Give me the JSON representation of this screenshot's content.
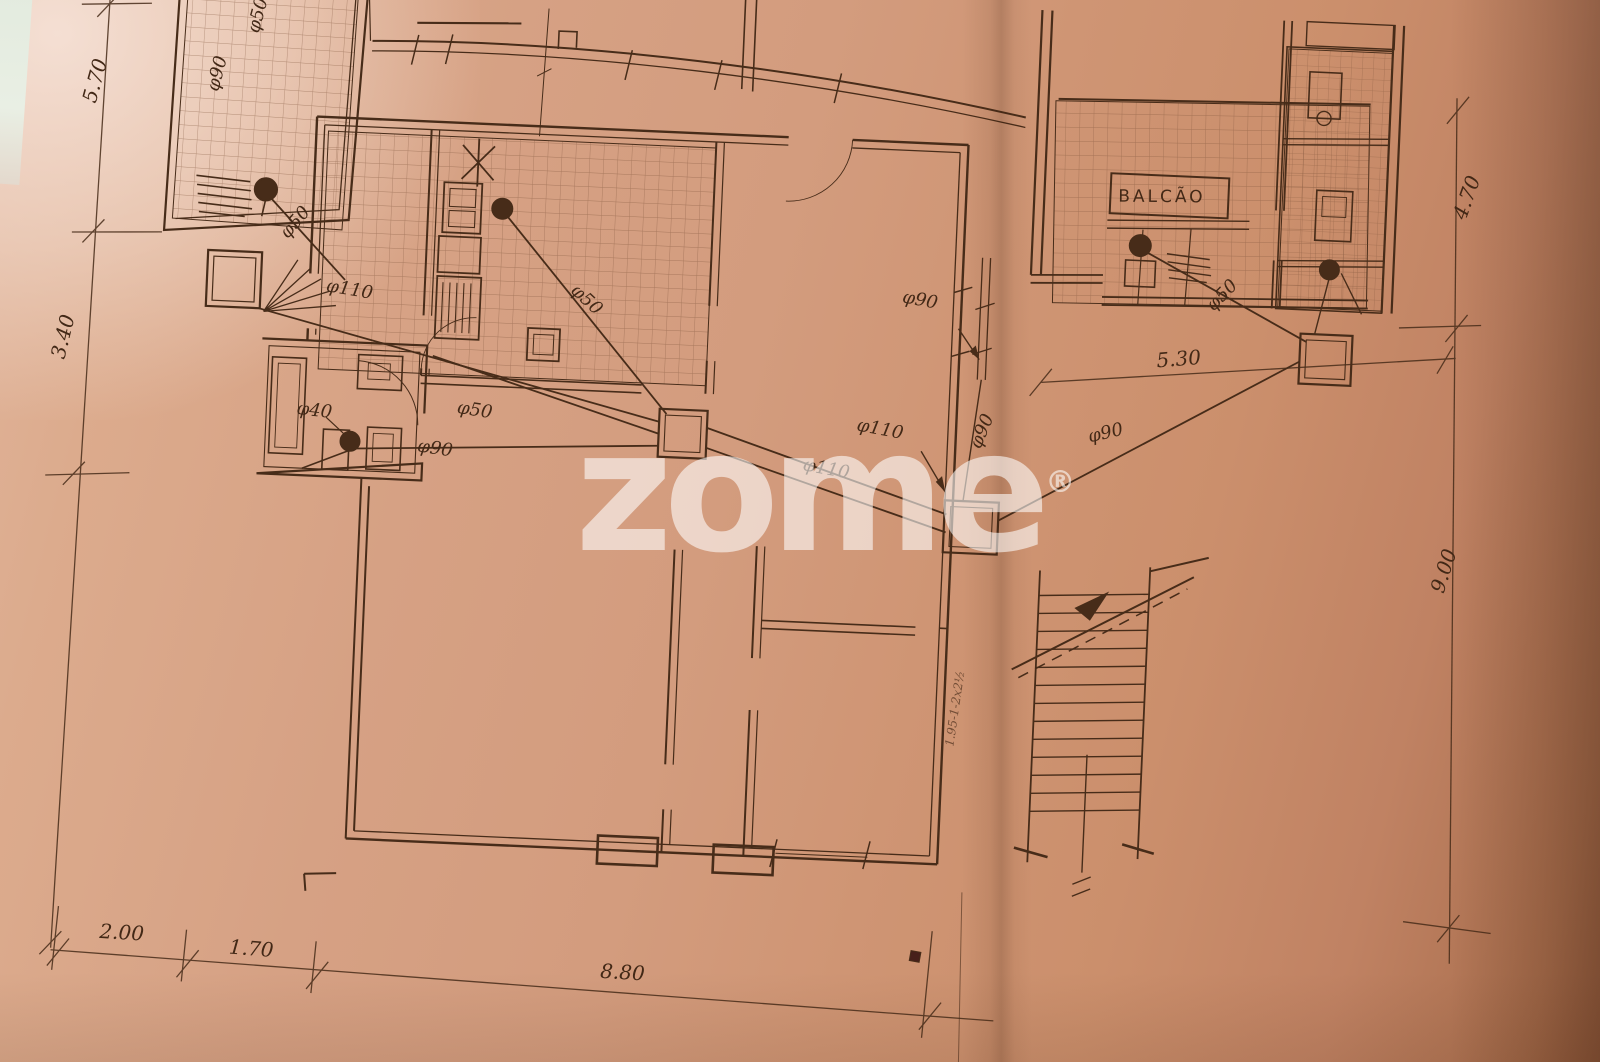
{
  "photo": {
    "watermark_text": "zome",
    "watermark_reg": "®",
    "paper_color": "#d6a184",
    "ink_color": "#472c19"
  },
  "plan": {
    "room_labels": {
      "balcao": "BALCÃO"
    },
    "dimensions": {
      "left_top": "5.70",
      "left_mid": "3.40",
      "bottom_1": "2.00",
      "bottom_2": "1.70",
      "bottom_3": "8.80",
      "right_top": "4.70",
      "right_side": "9.00",
      "upper_right": "5.30"
    },
    "pipe_labels": {
      "terrace_upper": "φ50",
      "terrace_lower": "φ90",
      "terrace_drain": "φ50",
      "main_left": "φ110",
      "kitchen_diag": "φ50",
      "hall_mid": "φ50",
      "bath_small": "φ40",
      "bath_main": "φ90",
      "center_a": "φ110",
      "center_b": "φ110",
      "wall_leader": "φ90",
      "wall_vertical": "φ90",
      "yard_cross": "φ90",
      "balcao_drain": "φ50"
    },
    "handwritten_note": "1.95-1-2x2½"
  }
}
